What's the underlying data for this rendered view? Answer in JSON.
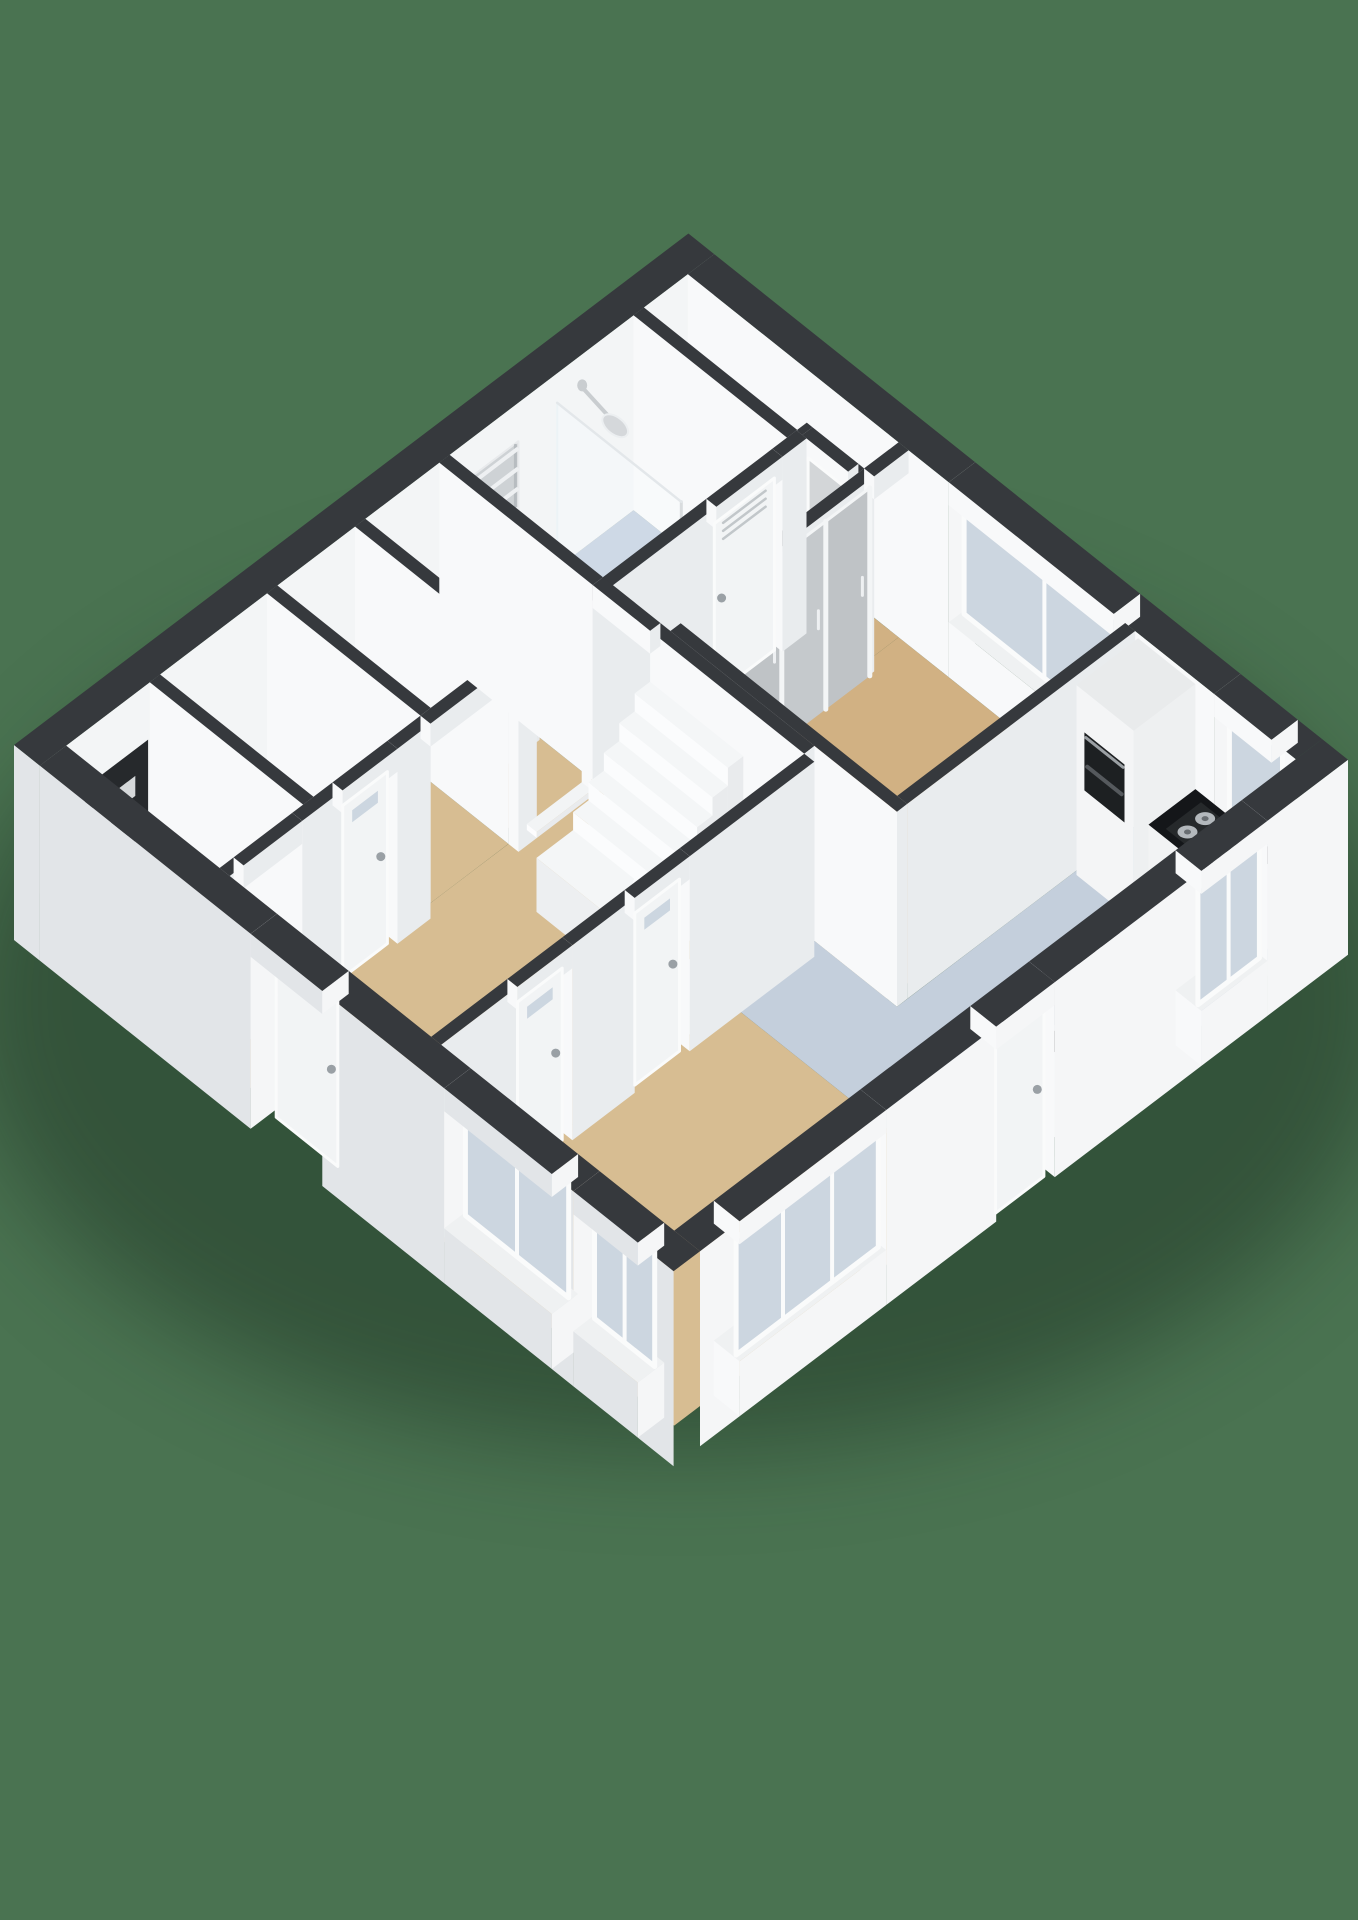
{
  "scene": {
    "background": "#4a7351",
    "shadow_color": "rgba(16,32,20,0.38)",
    "wall_height_px": 195,
    "view": "isometric-3d-floorplan"
  },
  "palette": {
    "background": "#4a7351",
    "wallTop": "#36393d",
    "faceSW": "#e2e5e8",
    "faceSE": "#f5f6f7",
    "faceIntU": "#f8f9fa",
    "faceIntV": "#e9ecee",
    "floorWood": "#d7bd92",
    "floorWoodDark": "#d1b183",
    "floorBlue": "#c4cfdc",
    "floorShower": "#bccadb",
    "floorPale": "#dfe4ea",
    "floorGray": "#e7eaed",
    "glass": "#ccd6e0",
    "frame": "#fafbfb",
    "leaf": "#f2f4f5",
    "leafGray": "#d3d6d8",
    "counterTop": "#141619",
    "applianceDark": "#1d2022",
    "metal": "#c3c8cc",
    "panelDark": "#26292c",
    "stepTop": "#f4f6f7",
    "stepFront": "#fbfcfd",
    "stepSide": "#edeff1",
    "wardrobe": "#c5c9cc",
    "wardrobeAlt": "#bfc3c6",
    "shadow": "rgba(16,32,20,0.38)"
  },
  "rooms": [
    {
      "name": "hall",
      "floor": "floorWood"
    },
    {
      "name": "living-room",
      "floor": "floorWood"
    },
    {
      "name": "kitchen",
      "floor": "floorBlue"
    },
    {
      "name": "bathroom",
      "floor": "floorPale"
    },
    {
      "name": "shower-area",
      "floor": "floorShower"
    },
    {
      "name": "vestibule",
      "floor": "floorBlue"
    },
    {
      "name": "bedroom",
      "floor": "floorWoodDark"
    },
    {
      "name": "bedroom-nook",
      "floor": "floorWoodDark"
    },
    {
      "name": "utility-room",
      "floor": "floorWood"
    },
    {
      "name": "closet",
      "floor": "floorWood"
    },
    {
      "name": "meter-cupboard",
      "floor": "floorGray"
    },
    {
      "name": "storage-niche",
      "floor": "floorGray"
    }
  ],
  "fixtures": [
    "staircase-winder",
    "shower-head",
    "shower-glass-screen",
    "towel-radiator",
    "washing-machine",
    "boiler",
    "wall-radiator",
    "meter-panel",
    "wardrobe-sliding-doors",
    "kitchen-counter",
    "gas-hob",
    "built-in-oven",
    "sink",
    "sink-faucet"
  ],
  "openings": {
    "exterior_doors": 2,
    "interior_doors": 5,
    "windows": 6
  }
}
